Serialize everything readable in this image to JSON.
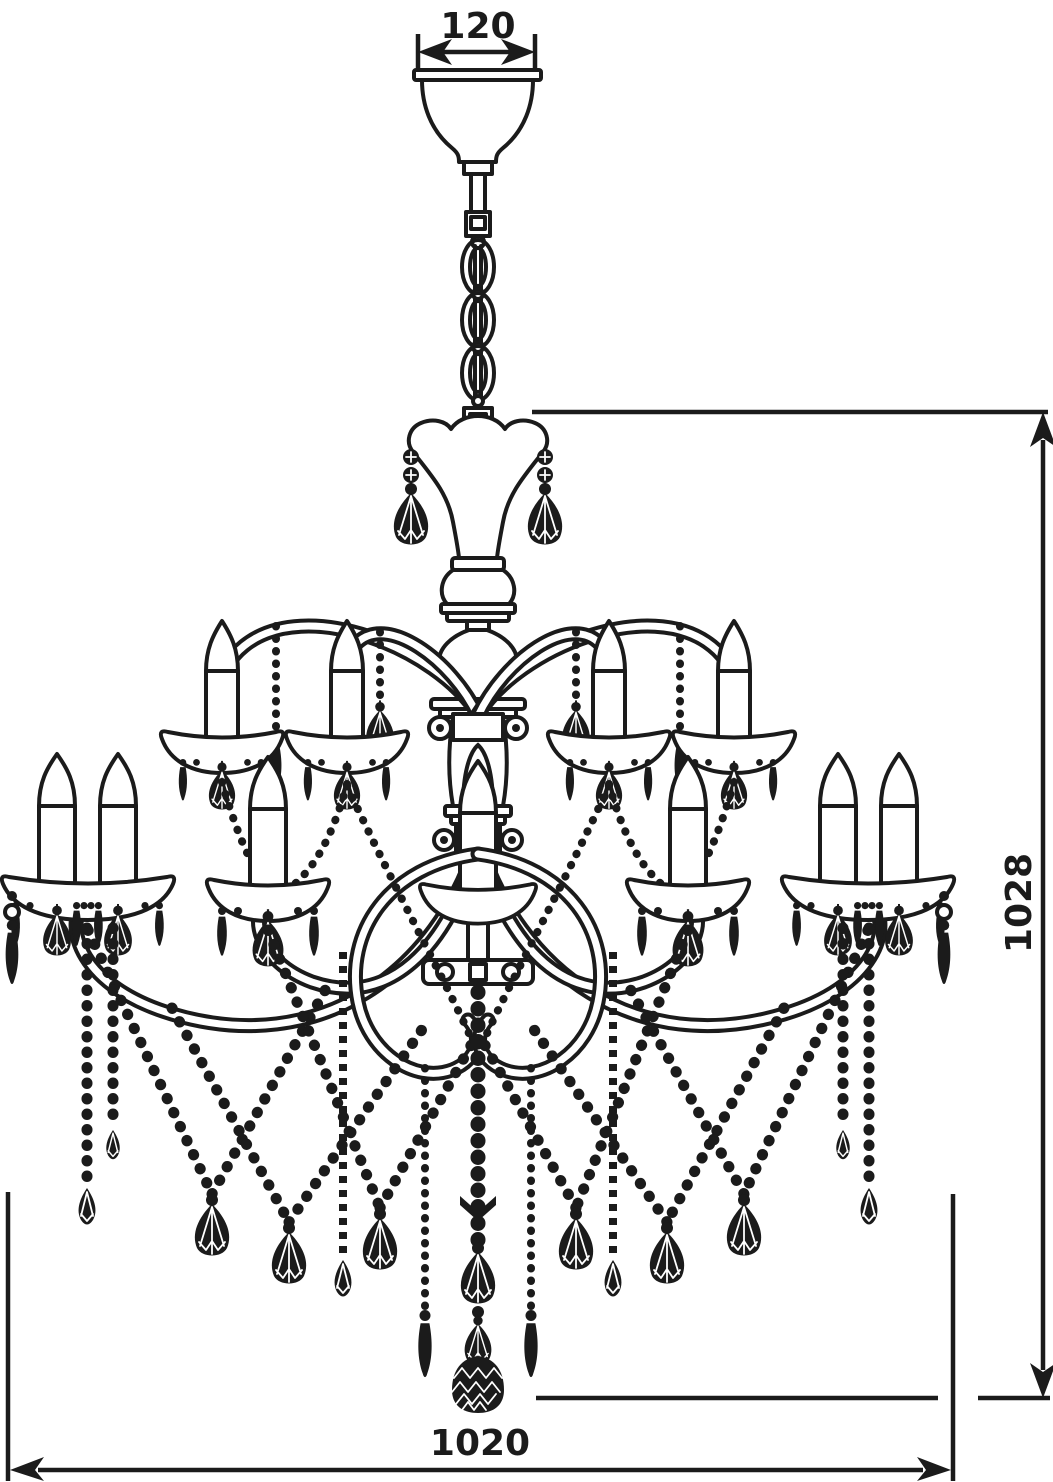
{
  "figure": {
    "title": "Chandelier dimensional line drawing",
    "type": "technical line drawing",
    "view": "front elevation",
    "ink_color": "#1b1b1b",
    "background_color": "#ffffff"
  },
  "dimensions": {
    "canopy_width": {
      "label": "120",
      "placement": "top",
      "arrows": "double-headed horizontal"
    },
    "height": {
      "label": "1028",
      "placement": "right",
      "arrows": "double-headed vertical"
    },
    "width": {
      "label": "1020",
      "placement": "bottom",
      "arrows": "double-headed horizontal"
    }
  },
  "components": {
    "canopy": "bell-shaped ceiling canopy",
    "chain_links": 3,
    "upper_tier_lights": 4,
    "lower_tier_lights": 7,
    "candle_style": "tapered candle sleeves on scalloped bobeches",
    "crystal_pendants": "faceted kite drops, spears and teardrops",
    "bead_swags": "criss-crossing beaded garlands",
    "bottom_finial": "faceted crystal ball"
  }
}
